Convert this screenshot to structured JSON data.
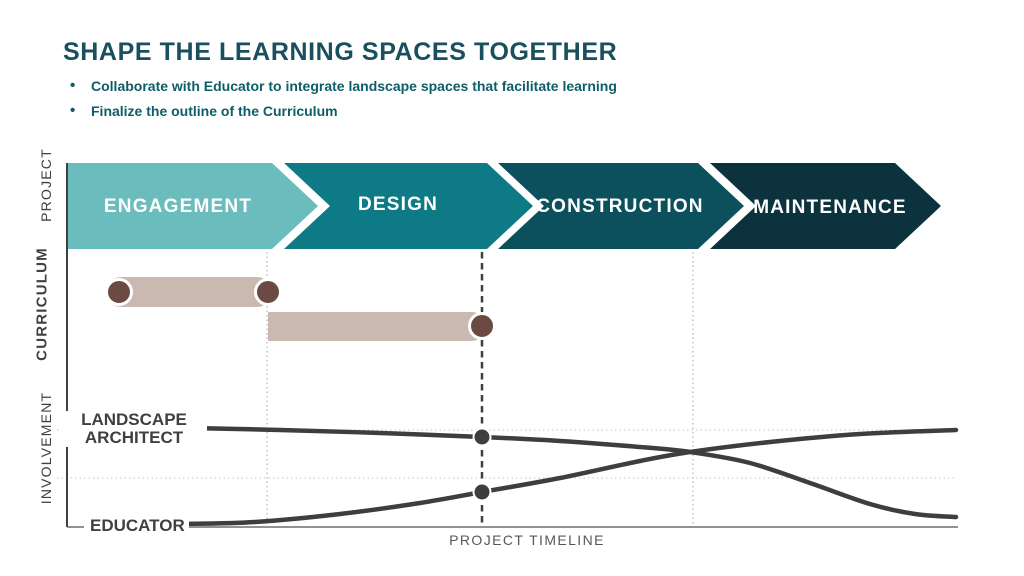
{
  "header": {
    "title": "SHAPE THE LEARNING SPACES TOGETHER",
    "bullets": [
      "Collaborate with Educator to integrate landscape spaces that facilitate learning",
      "Finalize the outline of the Curriculum"
    ]
  },
  "side_labels": {
    "project": "PROJECT",
    "curriculum": "CURRICULUM",
    "involvement": "INVOLVEMENT"
  },
  "curve_labels": {
    "landscape_line1": "LANDSCAPE",
    "landscape_line2": "ARCHITECT",
    "educator": "EDUCATOR"
  },
  "timeline_label": "PROJECT TIMELINE",
  "colors": {
    "title": "#19505e",
    "bullet_text": "#0e5d68",
    "bar": "#c9b9b1",
    "bar_dot": "#6a4a43",
    "curve": "#3d3e3e",
    "grid": "#c6c6c6",
    "dotted_line": "#b5b5b5",
    "dashed_line": "#3e3f3f",
    "axis_strong": "#3f4040",
    "axis_light": "#6d6e70",
    "label_dark": "#3f4041",
    "timeline_text": "#57585a"
  },
  "diagram": {
    "band": {
      "top": 163,
      "bottom": 249,
      "notch": 46
    },
    "phases": [
      {
        "label": "ENGAGEMENT",
        "color": "#6bbcbc",
        "x0": 68,
        "x1": 272,
        "notched": false
      },
      {
        "label": "DESIGN",
        "color": "#0d7a85",
        "x0": 284,
        "x1": 487,
        "notched": true
      },
      {
        "label": "CONSTRUCTION",
        "color": "#0c505d",
        "x0": 498,
        "x1": 698,
        "notched": true
      },
      {
        "label": "MAINTENANCE",
        "color": "#0b323d",
        "x0": 710,
        "x1": 895,
        "notched": true
      }
    ],
    "reference_lines": [
      {
        "x": 267,
        "style": "dotted"
      },
      {
        "x": 482,
        "style": "dashed"
      },
      {
        "x": 693,
        "style": "dotted"
      }
    ],
    "ref_top": 252,
    "ref_bottom": 527,
    "gridlines": [
      430,
      478
    ],
    "grid_x0": 57,
    "grid_x1": 956,
    "axis": {
      "x": 67,
      "top": 163,
      "baseline_y": 527,
      "baseline_segments": [
        [
          67,
          84
        ],
        [
          178,
          958
        ]
      ]
    },
    "bars": [
      {
        "x0": 106,
        "x1": 272,
        "y": 277,
        "h": 30,
        "rl": 15,
        "rr": 15,
        "dots": [
          [
            119,
            292
          ],
          [
            268,
            292
          ]
        ]
      },
      {
        "x0": 268,
        "x1": 486,
        "y": 312,
        "h": 29,
        "rl": 0,
        "rr": 14,
        "dots": [
          [
            482,
            326
          ]
        ]
      }
    ],
    "curves": [
      {
        "name": "landscape-architect",
        "points": [
          [
            190,
            428
          ],
          [
            280,
            430
          ],
          [
            380,
            433
          ],
          [
            482,
            437
          ],
          [
            560,
            441
          ],
          [
            640,
            447
          ],
          [
            690,
            452
          ],
          [
            750,
            463
          ],
          [
            810,
            483
          ],
          [
            870,
            504
          ],
          [
            915,
            514
          ],
          [
            956,
            517
          ]
        ]
      },
      {
        "name": "educator",
        "points": [
          [
            182,
            524
          ],
          [
            255,
            522
          ],
          [
            340,
            514
          ],
          [
            420,
            503
          ],
          [
            482,
            492
          ],
          [
            560,
            478
          ],
          [
            640,
            461
          ],
          [
            690,
            452
          ],
          [
            770,
            442
          ],
          [
            860,
            434
          ],
          [
            956,
            430
          ]
        ]
      }
    ],
    "markers": [
      [
        482,
        437
      ],
      [
        482,
        492
      ]
    ]
  }
}
